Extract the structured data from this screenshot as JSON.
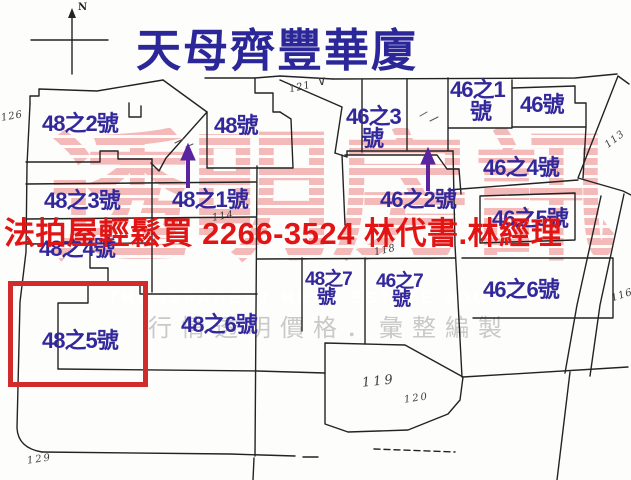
{
  "title": "天母齊豐華廈",
  "compass": {
    "label": "N"
  },
  "ad": {
    "text": "法拍屋輕鬆買  2266-3524  林代書.林經理",
    "color": "#e21414"
  },
  "highlight": {
    "parcel": "48之5號",
    "box_color": "#d22b2b"
  },
  "watermark": {
    "brand_cn": "透明房訊",
    "brand_en": "TRANSPARENT REAL ESTATE JOURNAL",
    "tagline": "行情透明價格．彙整編製",
    "pink": "#f1b4b4",
    "gray": "#c9c9c9"
  },
  "colors": {
    "parcel_label": "#32289b",
    "title": "#2b2799",
    "arrow": "#5a23a0",
    "map_line": "#232323",
    "handwriting": "#3b3b3b"
  },
  "parcels": [
    {
      "label": "48之2號"
    },
    {
      "label": "48號"
    },
    {
      "label": "48之3號"
    },
    {
      "label": "48之1號",
      "arrow": true
    },
    {
      "label": "46之3",
      "label2": "號"
    },
    {
      "label": "46之2號",
      "arrow": true
    },
    {
      "label": "46之1",
      "label2": "號"
    },
    {
      "label": "46號"
    },
    {
      "label": "46之4號"
    },
    {
      "label": "46之5號"
    },
    {
      "label": "48之4號"
    },
    {
      "label": "48之7",
      "label2": "號"
    },
    {
      "label": "46之7",
      "label2": "號"
    },
    {
      "label": "46之6號"
    },
    {
      "label": "48之6號"
    },
    {
      "label": "48之5號",
      "highlighted": true
    }
  ],
  "lot_numbers": [
    {
      "text": "126"
    },
    {
      "text": "121"
    },
    {
      "text": "113"
    },
    {
      "text": "114"
    },
    {
      "text": "118"
    },
    {
      "text": "116"
    },
    {
      "text": "119"
    },
    {
      "text": "120"
    },
    {
      "text": "129"
    }
  ],
  "marks": {
    "checkmark": "∨"
  }
}
